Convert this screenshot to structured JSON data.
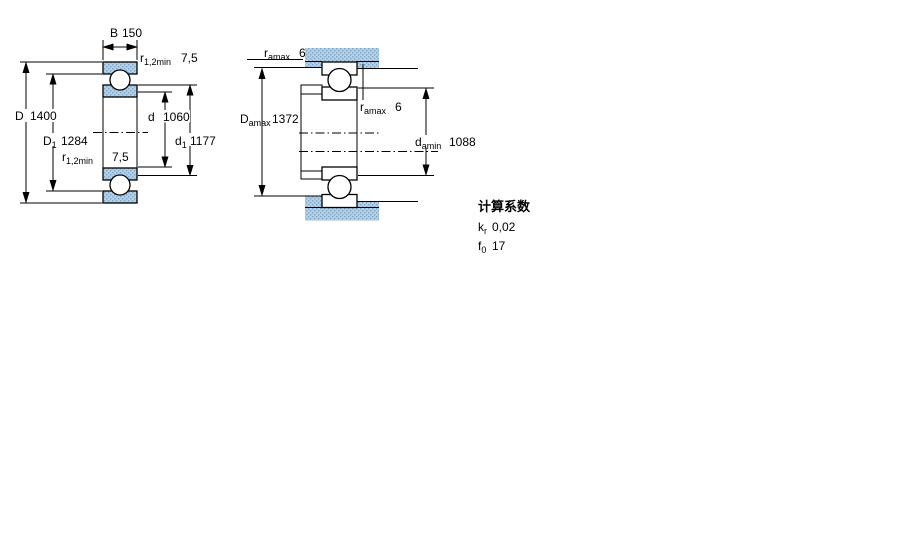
{
  "drawing": {
    "left": {
      "B": {
        "sym": "B",
        "val": "150"
      },
      "r_top": {
        "sym": "r",
        "sub": "1,2min",
        "val": "7,5"
      },
      "D": {
        "sym": "D",
        "val": "1400"
      },
      "D1": {
        "sym": "D",
        "sub": "1",
        "val": "1284"
      },
      "d": {
        "sym": "d",
        "val": "1060"
      },
      "d1": {
        "sym": "d",
        "sub": "1",
        "val": "1177"
      },
      "r_bottom": {
        "sym": "r",
        "sub": "1,2min",
        "val": "7,5"
      }
    },
    "right": {
      "ra_top": {
        "sym": "r",
        "sub": "amax",
        "val": "6"
      },
      "Damax": {
        "sym": "D",
        "sub": "amax",
        "val": "1372"
      },
      "ra_mid": {
        "sym": "r",
        "sub": "amax",
        "val": "6"
      },
      "damin": {
        "sym": "d",
        "sub": "amin",
        "val": "1088"
      }
    },
    "factors": {
      "title": "计算系数",
      "kr": {
        "sym": "k",
        "sub": "r",
        "val": "0,02"
      },
      "f0": {
        "sym": "f",
        "sub": "0",
        "val": "17"
      }
    },
    "colors": {
      "hatch_base": "#b5cfe3",
      "hatch_dot": "#7fa6c6",
      "line": "#000000"
    }
  }
}
